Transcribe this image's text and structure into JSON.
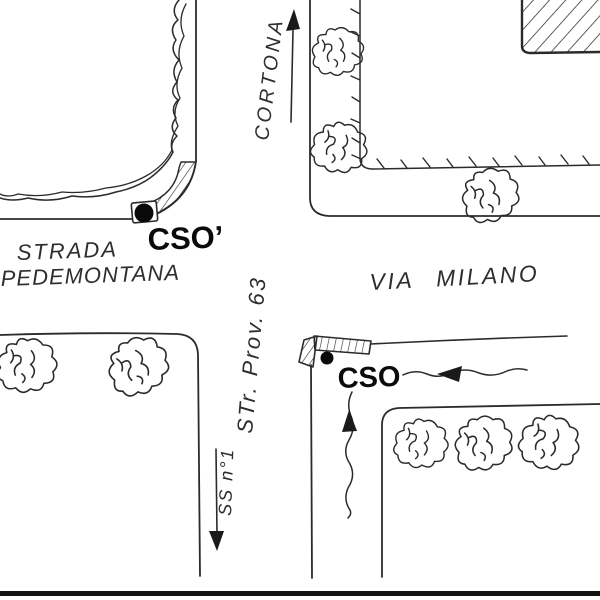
{
  "title": "Hand-drawn street sketch map",
  "colors": {
    "paper": "#ffffff",
    "ink": "#2b2b2b",
    "marker_fill": "#0a0a0a"
  },
  "labels": {
    "strada_line1": "STRADA",
    "strada_line2": "PEDEMONTANA",
    "via_milano": "VIA MILANO",
    "cortona": "CORTONA",
    "str_prov": "STr. Prov. 63",
    "ss_n1": "SS n°1",
    "cso_prime": "CSO’",
    "cso": "CSO"
  },
  "markers": [
    {
      "name": "cso-prime-dot",
      "label": "CSO’",
      "shape": "black-dot"
    },
    {
      "name": "cso-dot",
      "label": "CSO",
      "shape": "black-dot"
    }
  ],
  "arrows": [
    {
      "name": "cortona-direction-arrow",
      "direction": "up"
    },
    {
      "name": "ss-n1-direction-arrow",
      "direction": "down"
    },
    {
      "name": "approach-from-east-arrow",
      "direction": "left"
    },
    {
      "name": "approach-from-south-arrow",
      "direction": "up"
    }
  ]
}
